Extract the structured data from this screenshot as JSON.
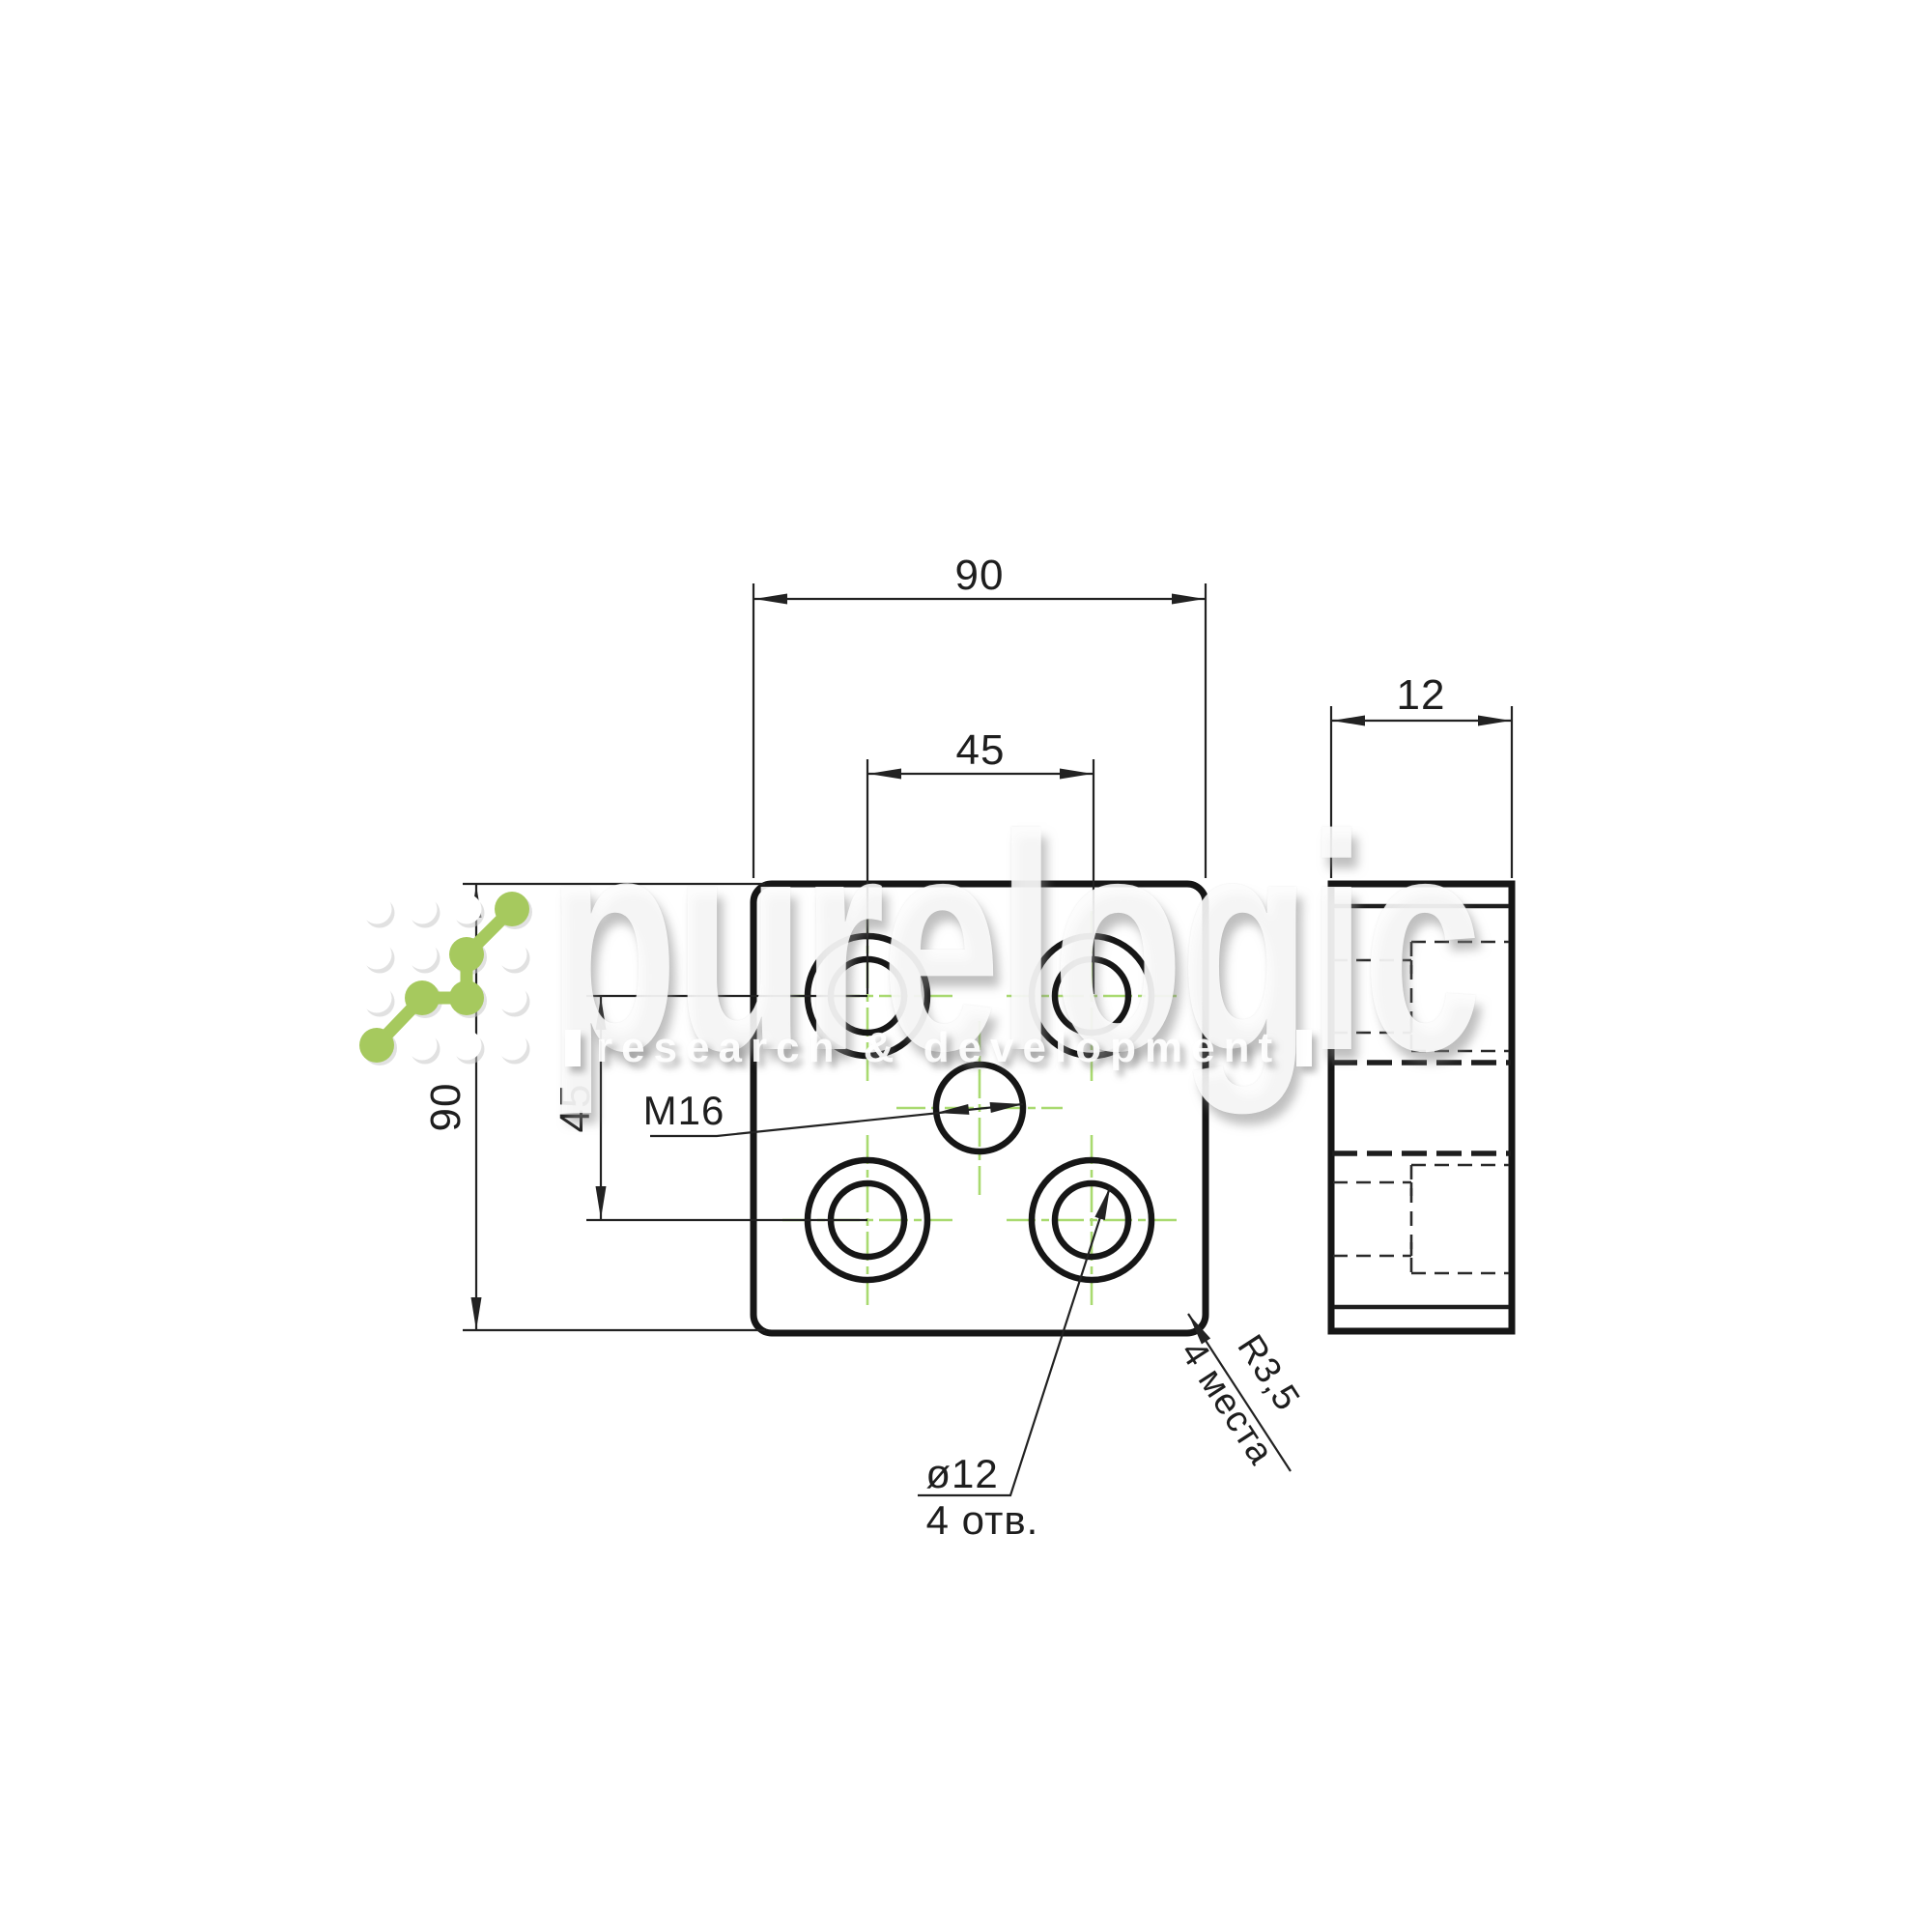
{
  "page": {
    "background": "#ffffff"
  },
  "watermark": {
    "title": "purelogic",
    "subtitle": "research & development",
    "logo_green": "#a6c95e"
  },
  "drawing": {
    "colors": {
      "line": "#1e1e1e",
      "centerline_green": "#a9da70"
    },
    "front_view": {
      "dim_width": "90",
      "dim_hole_spacing_horizontal": "45",
      "dim_height": "90",
      "dim_hole_spacing_vertical": "45",
      "label_center_hole": "M16",
      "label_holes_line1": "ø12",
      "label_holes_line2": "4 отв.",
      "label_corner_radius_line1": "R3,5",
      "label_corner_radius_line2": "4 места"
    },
    "side_view": {
      "dim_thickness": "12"
    }
  }
}
